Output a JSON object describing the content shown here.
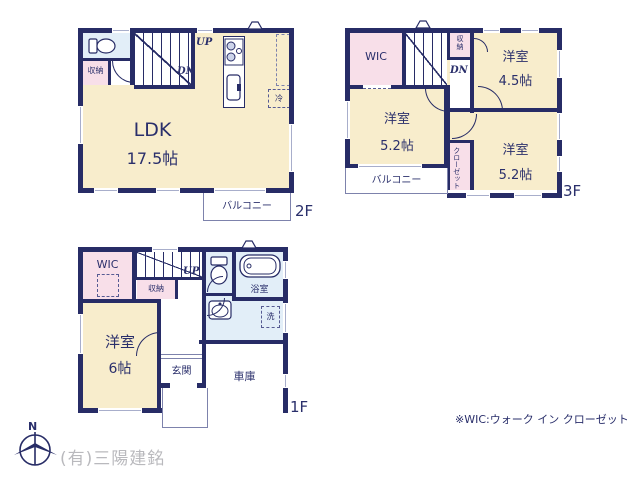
{
  "colors": {
    "wall": "#272c66",
    "room_cream": "#f8edcc",
    "room_pink": "#f8dfe9",
    "room_blue": "#e2eef8",
    "text": "#2a2f6b",
    "watermark": "#b9b9bd"
  },
  "floor2": {
    "label": "2F",
    "ldk": {
      "name": "LDK",
      "area": "17.5帖"
    },
    "storage": "収納",
    "up": "UP",
    "dn": "DN",
    "fridge": "冷",
    "balcony": "バルコニー"
  },
  "floor3": {
    "label": "3F",
    "wic": "WIC",
    "storage": "収納",
    "dn": "DN",
    "room45": {
      "name": "洋室",
      "area": "4.5帖"
    },
    "room52a": {
      "name": "洋室",
      "area": "5.2帖"
    },
    "room52b": {
      "name": "洋室",
      "area": "5.2帖"
    },
    "closet": "クローゼット",
    "balcony": "バルコニー"
  },
  "floor1": {
    "label": "1F",
    "wic": "WIC",
    "storage": "収納",
    "up": "UP",
    "bath": "浴室",
    "laundry": "洗",
    "bedroom": {
      "name": "洋室",
      "area": "6帖"
    },
    "entrance": "玄関",
    "garage": "車庫"
  },
  "compass": {
    "north": "N"
  },
  "footnote": "※WIC:ウォーク イン クローゼット",
  "company": "(有)三陽建銘"
}
